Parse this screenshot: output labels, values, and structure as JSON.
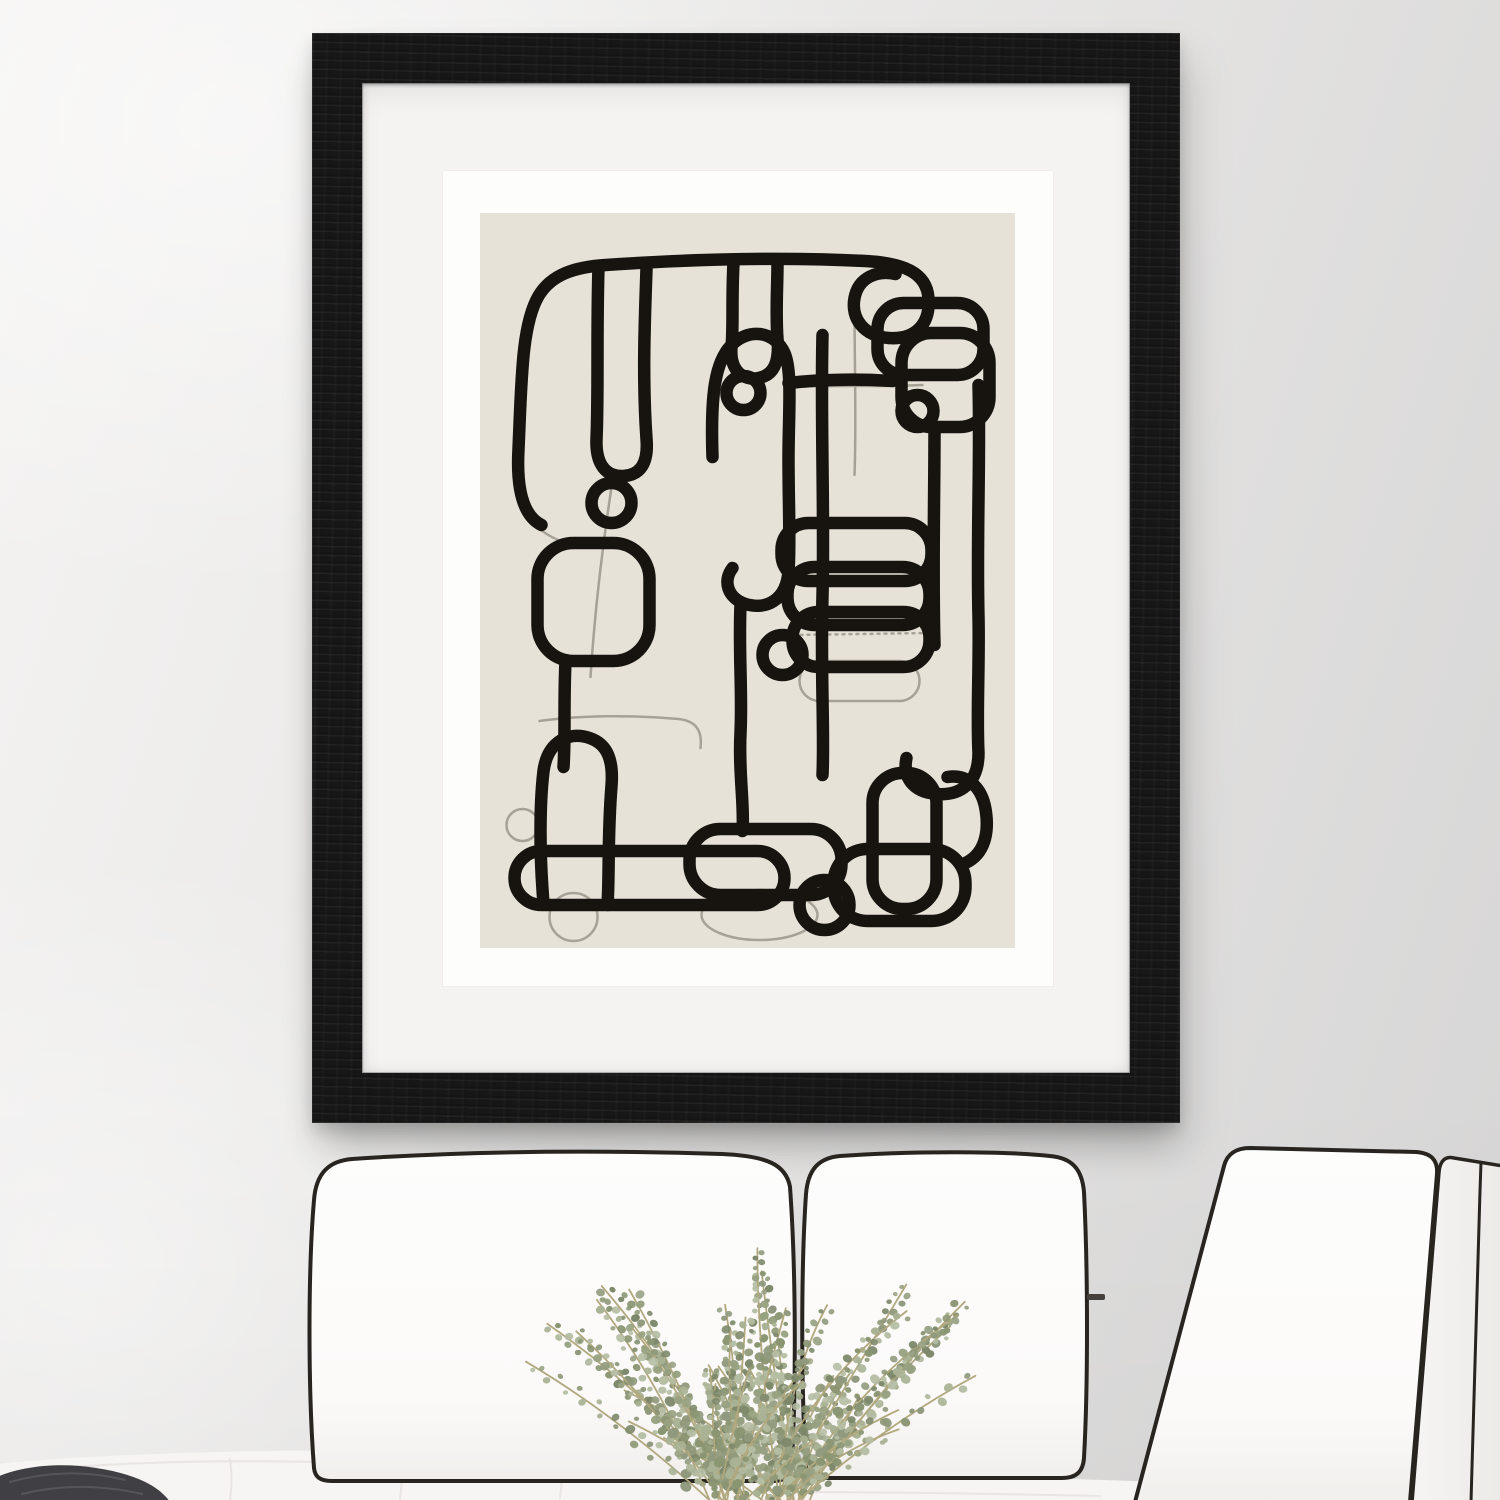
{
  "scene": {
    "description": "Black wood picture frame with a white mat displaying an abstract black continuous-line drawing on a beige background, hung on a light gray wall above a white sofa with black piping cushions, a dried eucalyptus bouquet and a dark knit throw pillow",
    "colors": {
      "wall-light": "#f5f4f3",
      "wall-mid": "#e7e6e5",
      "wall-dark": "#d6d5d5",
      "frame-wood": "#171717",
      "mat": "#f4f3f2",
      "paper": "#fdfdfc",
      "art-bg": "#e6e2d8",
      "art-line": "#17140f",
      "art-line-faded": "#9b968b",
      "sofa-fabric": "#fbfaf9",
      "sofa-fabric-side": "#f2f0ee",
      "sofa-piping": "#28241f",
      "sofa-seat": "#f6f5f3",
      "sofa-seam": "#e8e5e2",
      "throw-pillow": "#3f3f44",
      "throw-pillow-knit": "#55555a",
      "plant-stem": "#b1a87e"
    },
    "plant": {
      "leaf_colors": [
        "#97a181",
        "#8a9572",
        "#a9b294",
        "#7d886a",
        "#b5bda3",
        "#90997c"
      ]
    }
  }
}
